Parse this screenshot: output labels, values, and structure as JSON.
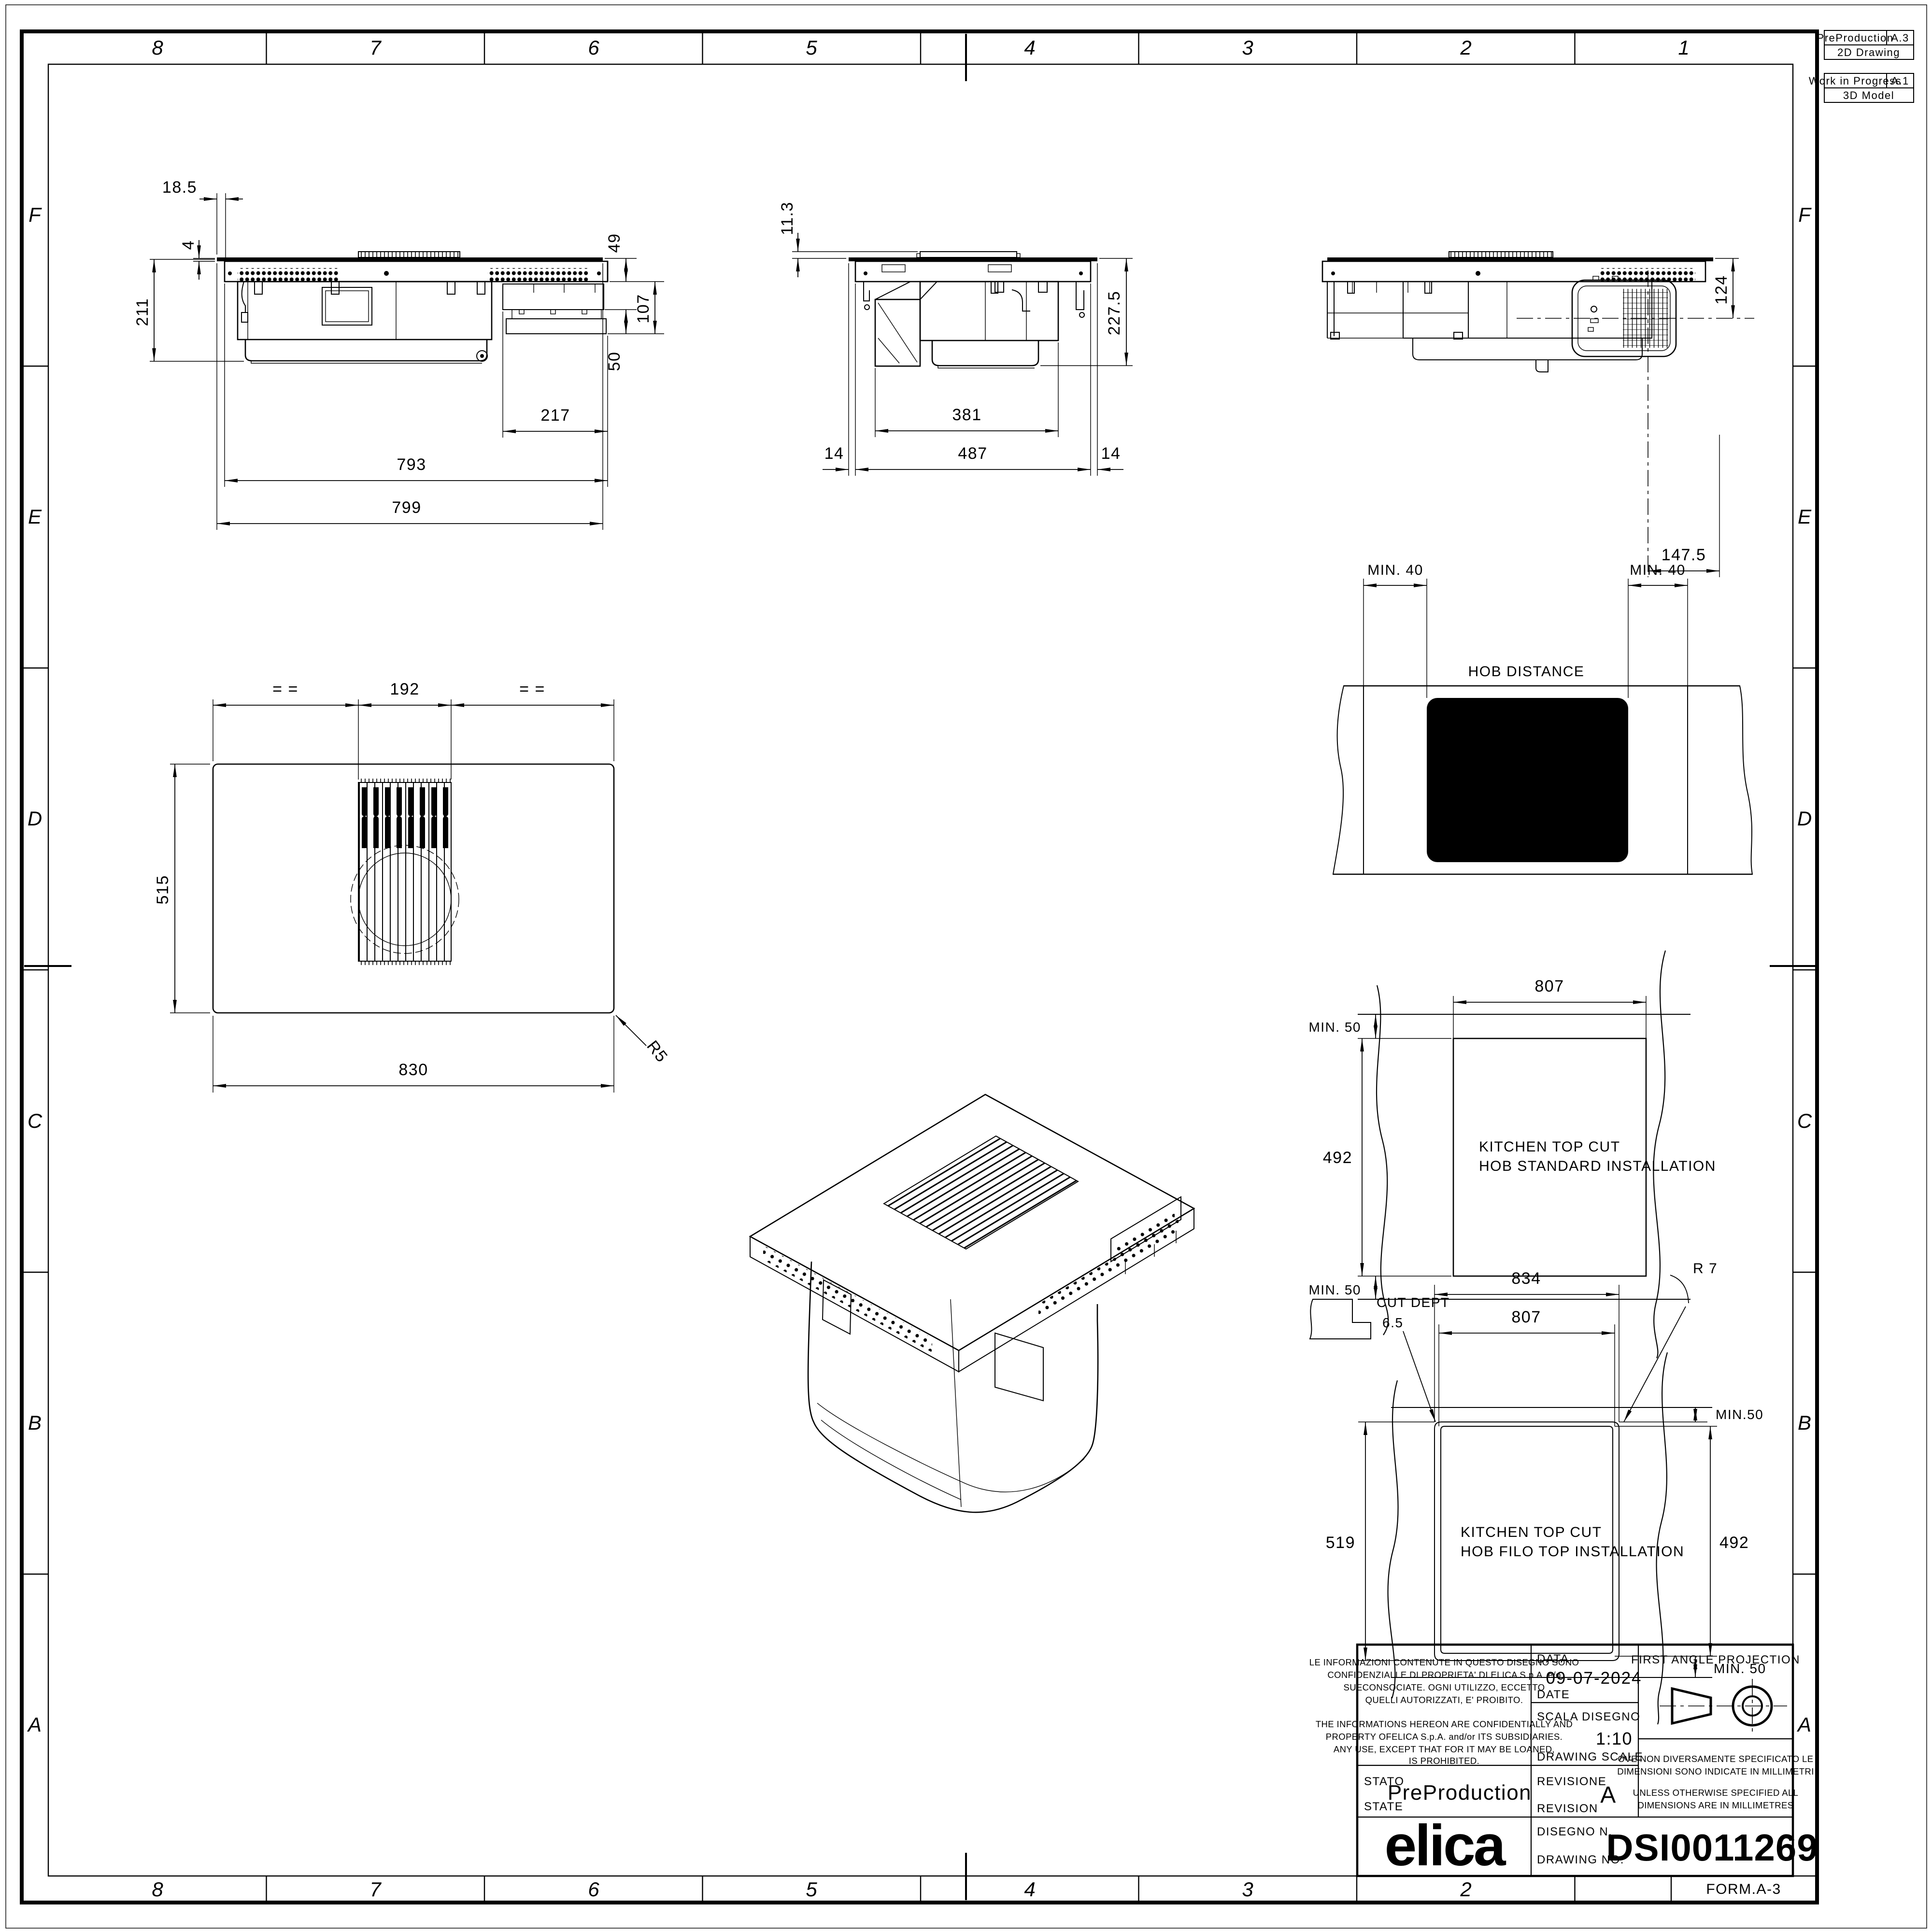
{
  "sheet": {
    "form": "FORM.A-3"
  },
  "zones": {
    "cols": [
      "8",
      "7",
      "6",
      "5",
      "4",
      "3",
      "2",
      "1"
    ],
    "rows": [
      "F",
      "E",
      "D",
      "C",
      "B",
      "A"
    ]
  },
  "corner": {
    "b1_state": "PreProduction",
    "b1_code": "A.3",
    "b1_kind": "2D Drawing",
    "b2_state": "Work in Progress",
    "b2_code": "A.1",
    "b2_kind": "3D Model"
  },
  "front": {
    "off": "18.5",
    "glass": "4",
    "h": "211",
    "drop": "49",
    "mid": "107",
    "gap": "50",
    "rail": "217",
    "body": "793",
    "overall": "799"
  },
  "side": {
    "step": "11.3",
    "h": "227.5",
    "duct": "381",
    "m1": "14",
    "inner": "487",
    "m2": "14"
  },
  "back": {
    "out": "124",
    "ctr": "147.5"
  },
  "plan": {
    "eq1": "= =",
    "grille": "192",
    "eq2": "= =",
    "depth": "515",
    "width": "830",
    "rad": "R5"
  },
  "hobdist": {
    "min1": "MIN. 40",
    "min2": "MIN. 40",
    "label": "HOB DISTANCE"
  },
  "std": {
    "w": "807",
    "mintop": "MIN. 50",
    "h": "492",
    "minbot": "MIN. 50",
    "t1": "KITCHEN TOP CUT",
    "t2": "HOB STANDARD INSTALLATION"
  },
  "filo": {
    "outer": "834",
    "inner": "807",
    "rad": "R 7",
    "cutlbl": "CUT DEPT",
    "cutval": "6.5",
    "mintop": "MIN.50",
    "h": "492",
    "minbot": "MIN. 50",
    "depth": "519",
    "t1": "KITCHEN TOP CUT",
    "t2": "HOB FILO TOP INSTALLATION"
  },
  "tb": {
    "legal_it": [
      "LE INFORMAZIONI CONTENUTE IN QUESTO DISEGNO SONO",
      "CONFIDENZIALI E DI PROPRIETA' DI ELICA S.p.A. e/o",
      "SUECONSOCIATE. OGNI UTILIZZO, ECCETTO",
      "QUELLI AUTORIZZATI, E' PROIBITO."
    ],
    "legal_en": [
      "THE INFORMATIONS HEREON ARE CONFIDENTIALLY AND",
      "PROPERTY OFELICA S.p.A.  and/or ITS SUBSIDIARIES.",
      "ANY USE, EXCEPT THAT FOR IT MAY BE LOANED,",
      "IS PROHIBITED."
    ],
    "data_l": "DATA",
    "date_l": "DATE",
    "date_v": "09-07-2024",
    "scala_l": "SCALA DISEGNO",
    "scale_l": "DRAWING SCALE",
    "scale_v": "1:10",
    "stato_l": "STATO",
    "state_l": "STATE",
    "state_v": "PreProduction",
    "rev_l": "REVISIONE",
    "revision_l": "REVISION",
    "rev_v": "A",
    "dis_l": "DISEGNO N.",
    "dwg_l": "DRAWING NO.",
    "dwg_v": "DSI0011269",
    "fap": "FIRST ANGLE PROJECTION",
    "note_it": [
      "OVE NON DIVERSAMENTE SPECIFICATO LE",
      "DIMENSIONI SONO INDICATE IN MILLIMETRI"
    ],
    "note_en": [
      "UNLESS OTHERWISE SPECIFIED ALL",
      "DIMENSIONS ARE IN MILLIMETRES"
    ],
    "logo": "elica"
  },
  "colors": {
    "ink": "#000000",
    "paper": "#ffffff"
  }
}
